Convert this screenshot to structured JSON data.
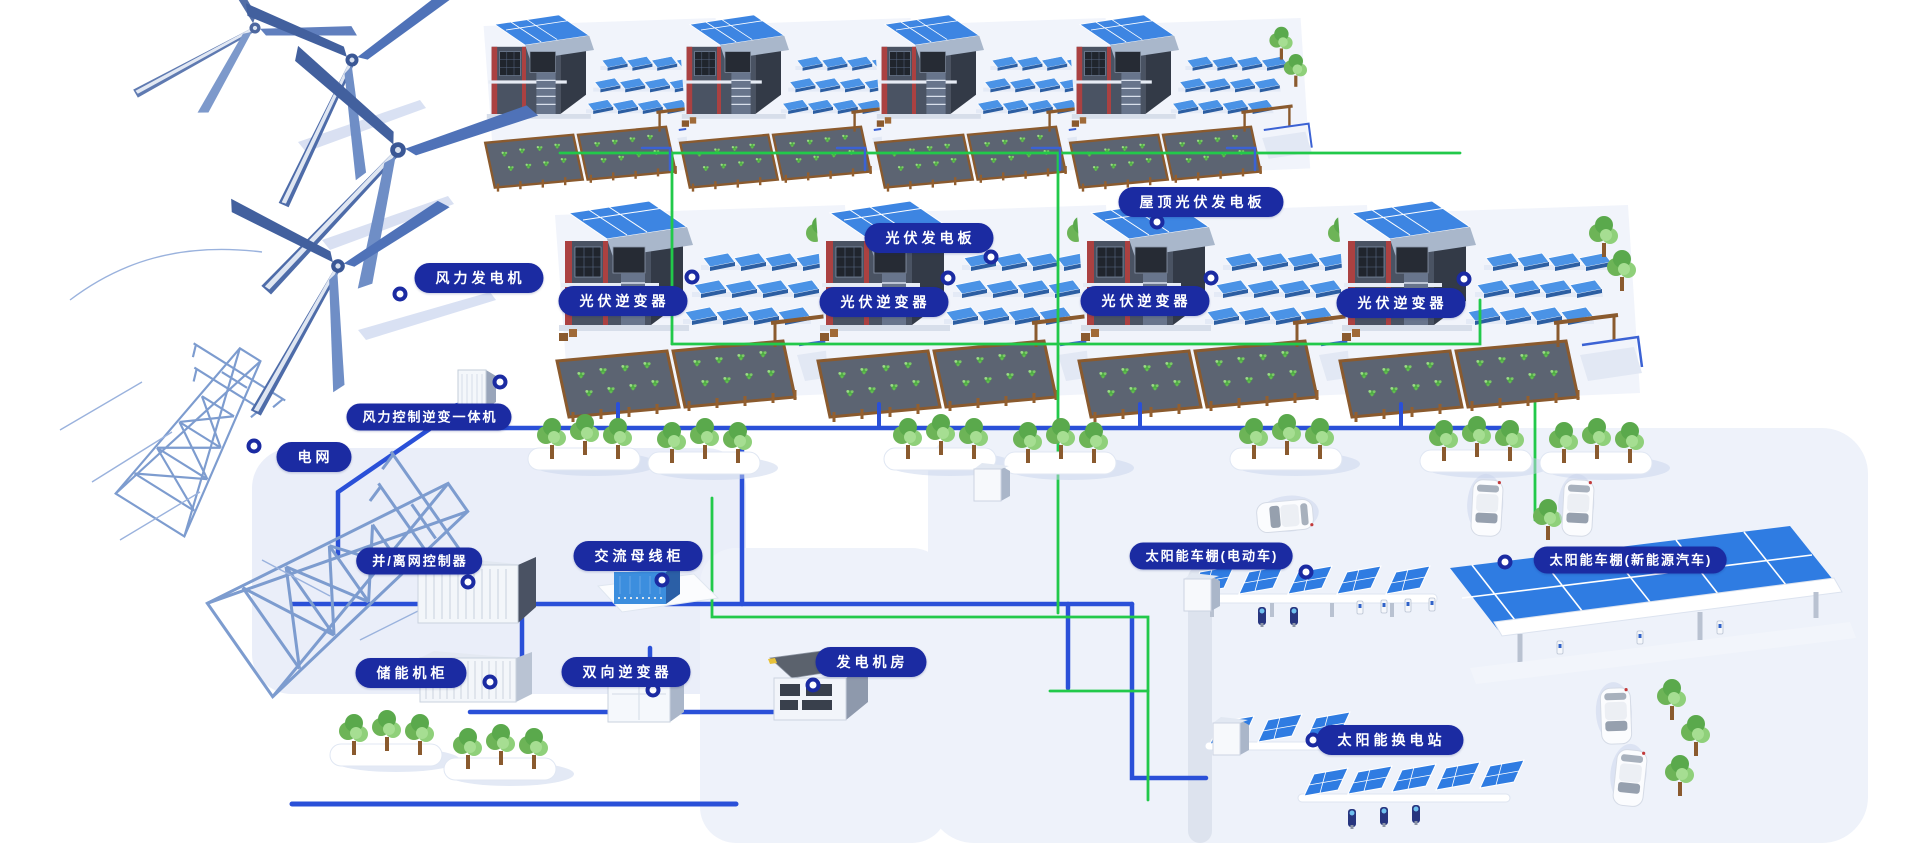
{
  "labels": {
    "wind_turbine": "风力发电机",
    "wind_control_inverter": "风力控制逆变一体机",
    "power_grid": "电网",
    "pv_panel": "光伏发电板",
    "roof_pv_panel": "屋顶光伏发电板",
    "pv_inverter": "光伏逆变器",
    "grid_tie_controller": "并/离网控制器",
    "ac_busbar_cabinet": "交流母线柜",
    "energy_storage_cabinet": "储能机柜",
    "bidirectional_inverter": "双向逆变器",
    "generator_room": "发电机房",
    "solar_carport_ev": "太阳能车棚(电动车)",
    "solar_carport_nev": "太阳能车棚(新能源汽车)",
    "solar_swap_station": "太阳能换电站"
  },
  "colors": {
    "label_background": "#1b2ba2",
    "label_text": "#ffffff",
    "line_blue": "#2a50d8",
    "line_green": "#22c94a",
    "solar_panel_blue": "#3d85e2",
    "building_gray": "#4a5363",
    "building_red": "#ab4141",
    "tree_green": "#6db457",
    "platform_tint": "#edf1fa"
  }
}
